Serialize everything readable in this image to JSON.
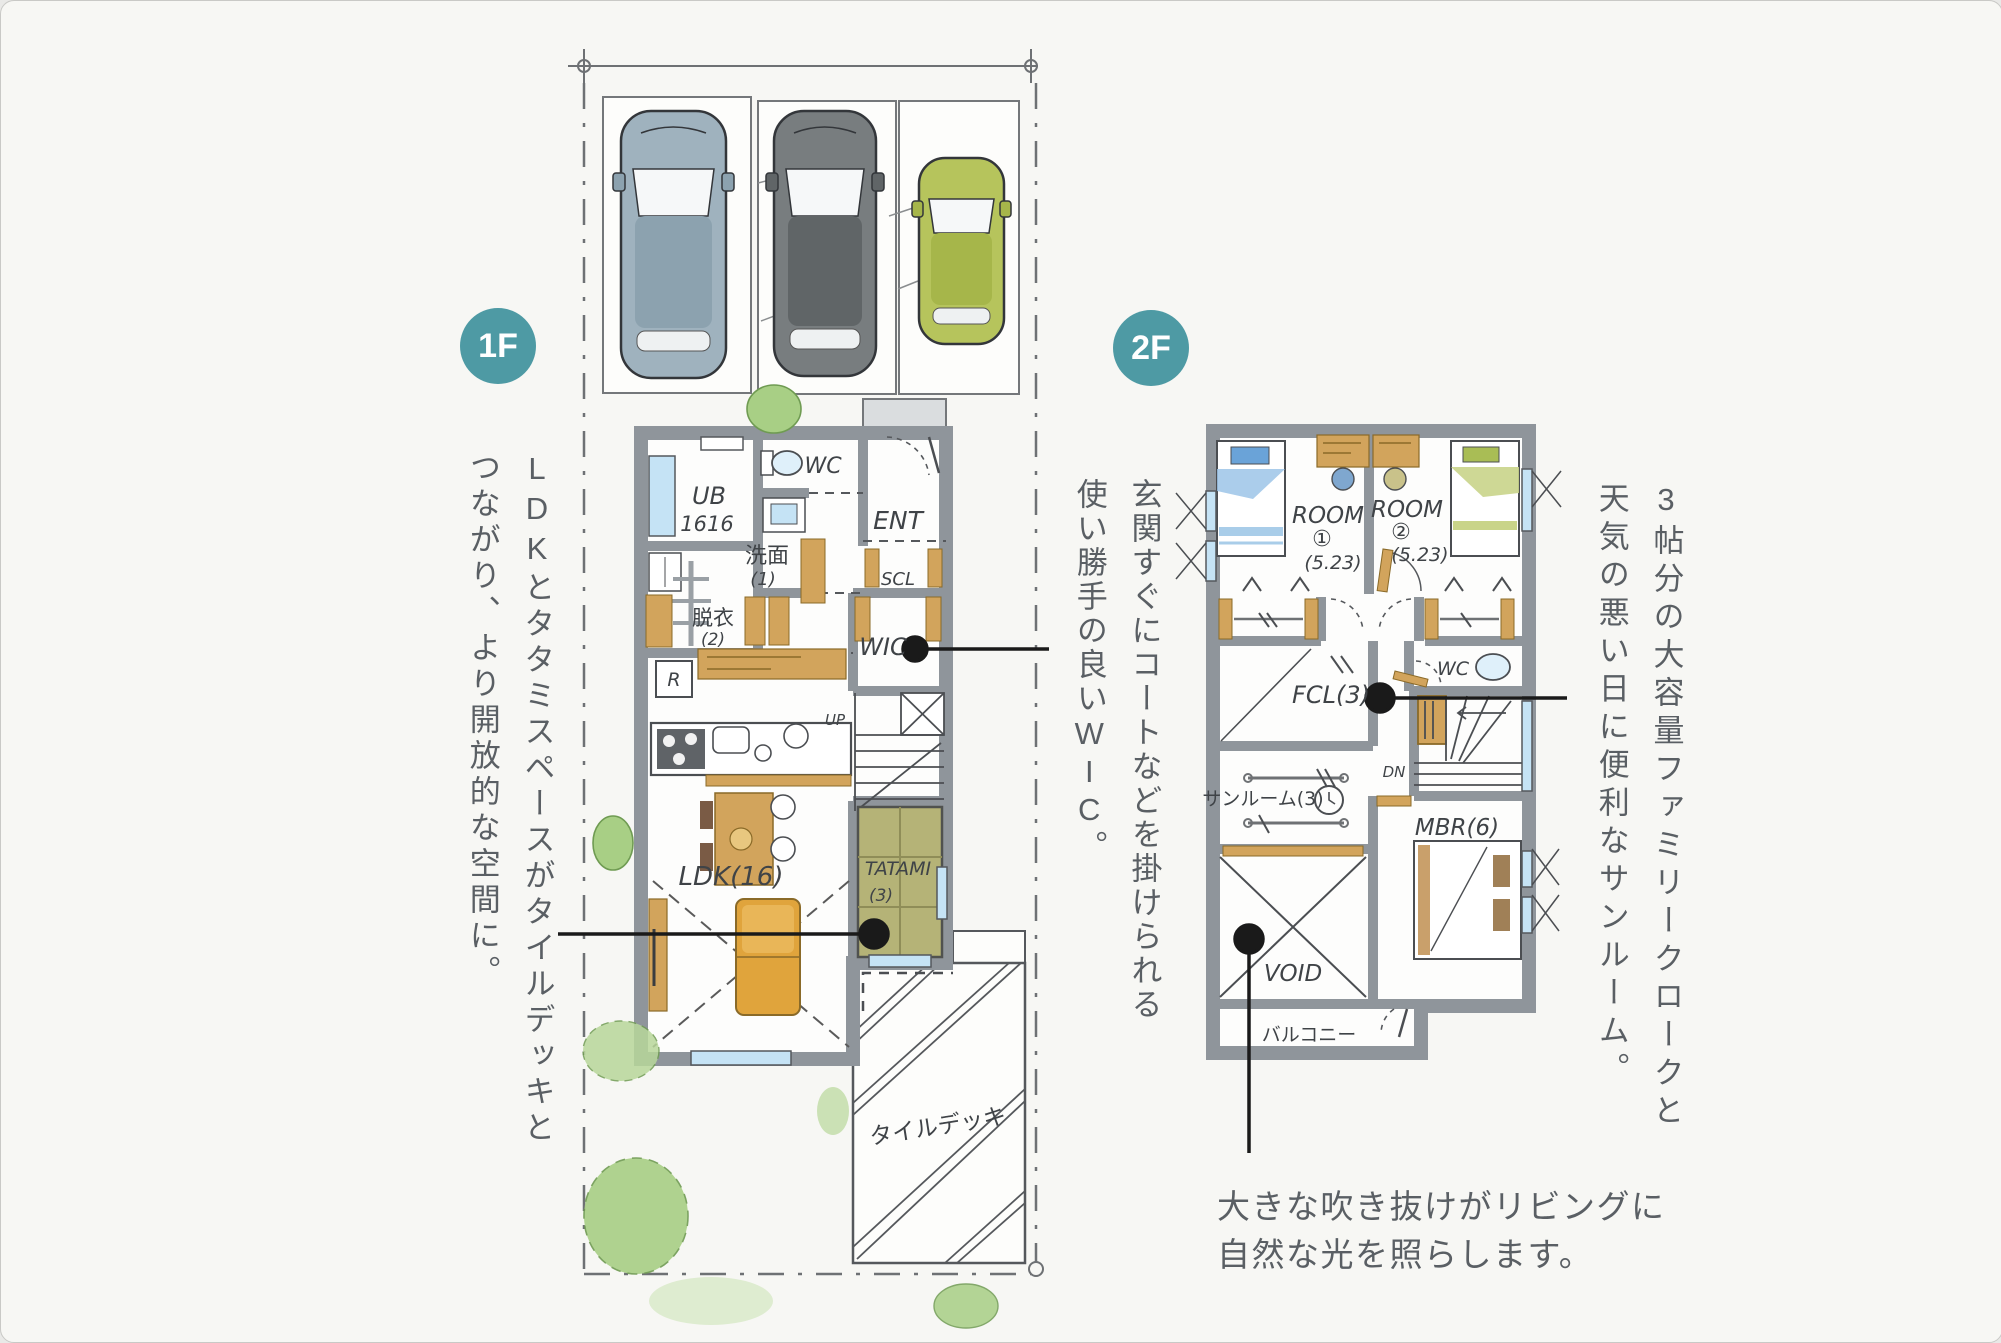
{
  "colors": {
    "accent": "#4E9AA4",
    "wall": "#8F959B",
    "ink": "#4B4E52",
    "text": "#5A5F64",
    "callout": "#1A1A1A",
    "wood": "#D2A45C",
    "tatami": "#B5B377",
    "window": "#C5E3F5",
    "sofa": "#E0A43C",
    "bush": "#A8CF85",
    "car_blue_gray": "#9FB2BE",
    "car_dark_gray": "#787D7F",
    "car_green": "#B6C45C"
  },
  "badges": {
    "floor1": "1F",
    "floor2": "2F"
  },
  "plan1f": {
    "rooms": {
      "ub_line1": "UB",
      "ub_line2": "1616",
      "wc": "WC",
      "ent": "ENT",
      "scl": "SCL",
      "senmen_line1": "洗面",
      "senmen_line2": "(1)",
      "datsui_line1": "脱衣",
      "datsui_line2": "(2)",
      "wic": "WIC",
      "fridge": "R",
      "up": "UP",
      "ldk": "LDK(16)",
      "tatami_line1": "TATAMI",
      "tatami_line2": "(3)",
      "tile_deck": "タイルデッキ"
    }
  },
  "plan2f": {
    "rooms": {
      "room1_line1": "ROOM",
      "room1_line2": "①",
      "room1_line3": "(5.23)",
      "room2_line1": "ROOM",
      "room2_line2": "②",
      "room2_line3": "(5.23)",
      "wc": "WC",
      "fcl": "FCL(3)",
      "dn": "DN",
      "sunroom": "サンルーム(3)",
      "mbr": "MBR(6)",
      "void": "VOID",
      "balcony": "バルコニー"
    }
  },
  "annotations": {
    "left_line1": "LDKとタタミスペースがタイルデッキと",
    "left_line2": "つながり、より開放的な空間に。",
    "middle_line1": "玄関すぐにコートなどを掛けられる",
    "middle_line2": "使い勝手の良いWIC。",
    "right_line1": "3帖分の大容量ファミリークロークと",
    "right_line2": "天気の悪い日に便利なサンルーム。",
    "bottom_line1": "大きな吹き抜けがリビングに",
    "bottom_line2": "自然な光を照らします。"
  }
}
